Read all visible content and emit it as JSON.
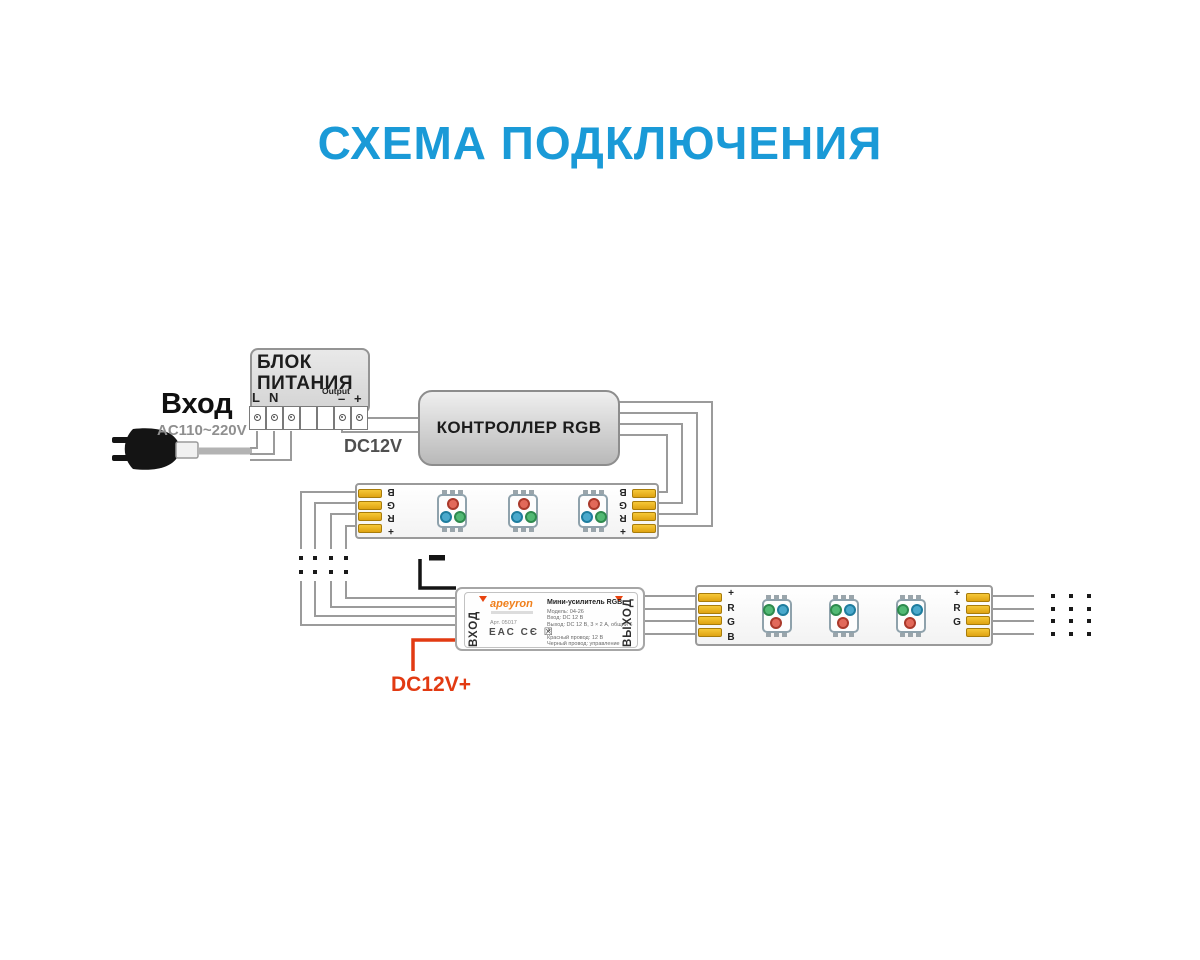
{
  "title": "СХЕМА ПОДКЛЮЧЕНИЯ",
  "colors": {
    "title": "#1a9ad7",
    "wire": "#9b9b9b",
    "red_wire": "#e23a12",
    "black_wire": "#141414",
    "pad_gold": "#e8b41f",
    "led_red": "#e2695a",
    "led_green": "#52b974",
    "led_blue": "#4aa9cc"
  },
  "power_input": {
    "label": "Вход",
    "voltage": "AC110~220V"
  },
  "psu": {
    "title": "БЛОК\nПИТАНИЯ",
    "terminal_l": "L",
    "terminal_n": "N",
    "ground_icon": "earth-ground",
    "output_label": "Output",
    "output_minus": "–",
    "output_plus": "+",
    "dc_output": "DC12V"
  },
  "controller": {
    "label": "КОНТРОЛЛЕР RGB"
  },
  "strip1": {
    "labels_left": [
      "B",
      "G",
      "R",
      "+"
    ],
    "labels_right": [
      "B",
      "G",
      "R",
      "+"
    ]
  },
  "strip2": {
    "labels_left": [
      "+",
      "R",
      "G",
      "B"
    ],
    "labels_right": [
      "+",
      "R",
      "G",
      "B"
    ]
  },
  "amplifier": {
    "input_label": "ВХОД",
    "output_label": "ВЫХОД",
    "brand": "apeyron",
    "product_title": "Мини-усилитель RGB",
    "specs": [
      "Модель: 04-26",
      "Вход: DC 12 В",
      "Выход: DC 12 В, 3 × 2 А, общий 6 А",
      "Красный провод: 12 В",
      "Черный провод: управление"
    ],
    "art": "Арт. 05017",
    "cert_marks": "ЕАС CЄ ☒"
  },
  "annotations": {
    "minus_wire": "–",
    "plus_wire": "DC12V+"
  }
}
